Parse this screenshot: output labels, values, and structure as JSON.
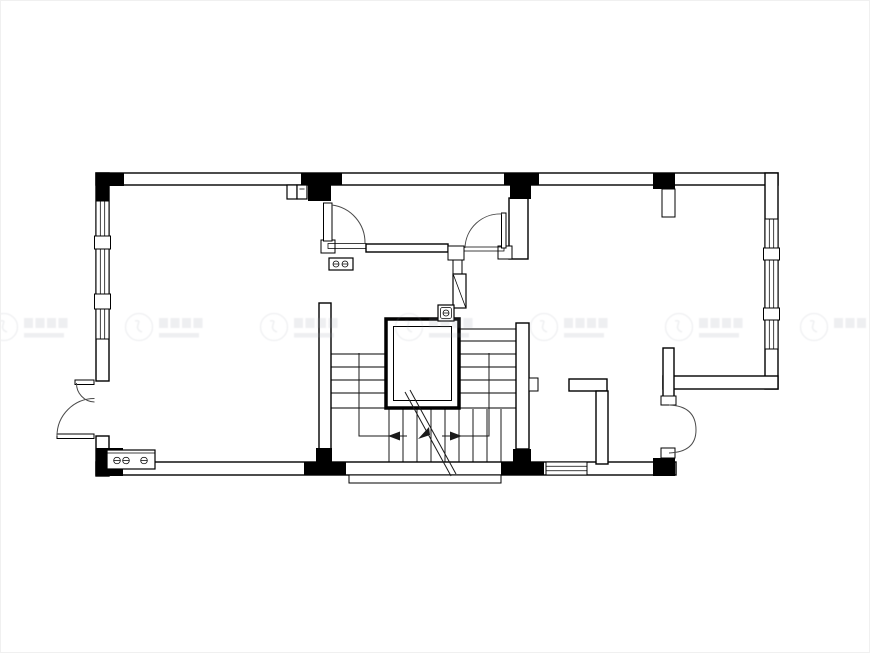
{
  "meta": {
    "type": "architectural-floor-plan",
    "aria_label": "Black and white residential floor plan drawing with staircase, elevator shaft, doors, windows and watermark row",
    "canvas_width": 870,
    "canvas_height": 653
  },
  "colors": {
    "background": "#ffffff",
    "wall_line": "#000000",
    "wall_fill": "#ffffff",
    "column_fill": "#000000",
    "door_arc": "#4a4a4a",
    "watermark": "#9aa0ac",
    "frame_border": "#f0f0f0"
  },
  "watermarks": {
    "count": 7,
    "opacity": "0.16",
    "note": "repeating translucent circular logo with illegible text, single horizontal row"
  },
  "features": {
    "exterior_walls": "rectangular footprint with notched lower-right corner",
    "windows": [
      "left wall: 3 glazed sections with mullion blocks",
      "right wall: 3 glazed sections with mullion blocks",
      "bottom wall: 1 glazed section"
    ],
    "doors": [
      "interior swing door at top-left hall",
      "interior swing door at top-center hall",
      "exterior unequal double door on left wall",
      "folding door at lower-right notch"
    ],
    "staircase": "U-return stair around central shaft with treads, walk lines, direction arrows and diagonal break line",
    "shaft": "central elevator / stair void with double border",
    "columns": "black structural columns at corners and wall intersections",
    "fixtures": [
      "meter box with circles at lower-left",
      "small meter box near hall threshold",
      "duct with diagonal",
      "small box with dial above shaft"
    ]
  }
}
